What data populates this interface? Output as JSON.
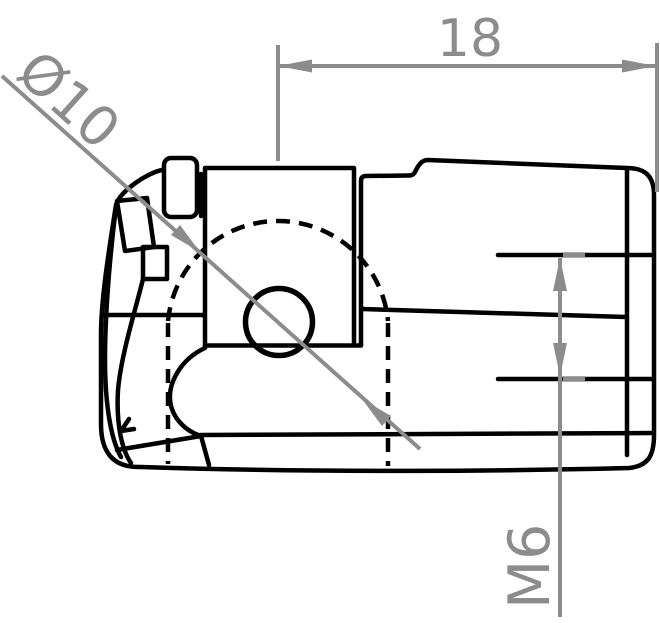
{
  "drawing": {
    "type": "technical-drawing",
    "part": "ball-socket-end-fitting-side-view",
    "dimensions": {
      "length": {
        "label": "18",
        "unit_note": "horizontal overall dimension, ball center to right end"
      },
      "ball_diameter": {
        "label": "Ø10",
        "unit_note": "diameter of hidden ball socket sphere, diagonal leader"
      },
      "thread": {
        "label": "M6",
        "unit_note": "vertical thread size dimension at right end"
      }
    },
    "colors": {
      "line": "#000000",
      "dimension": "#8c8c8c",
      "background": "#ffffff"
    }
  }
}
